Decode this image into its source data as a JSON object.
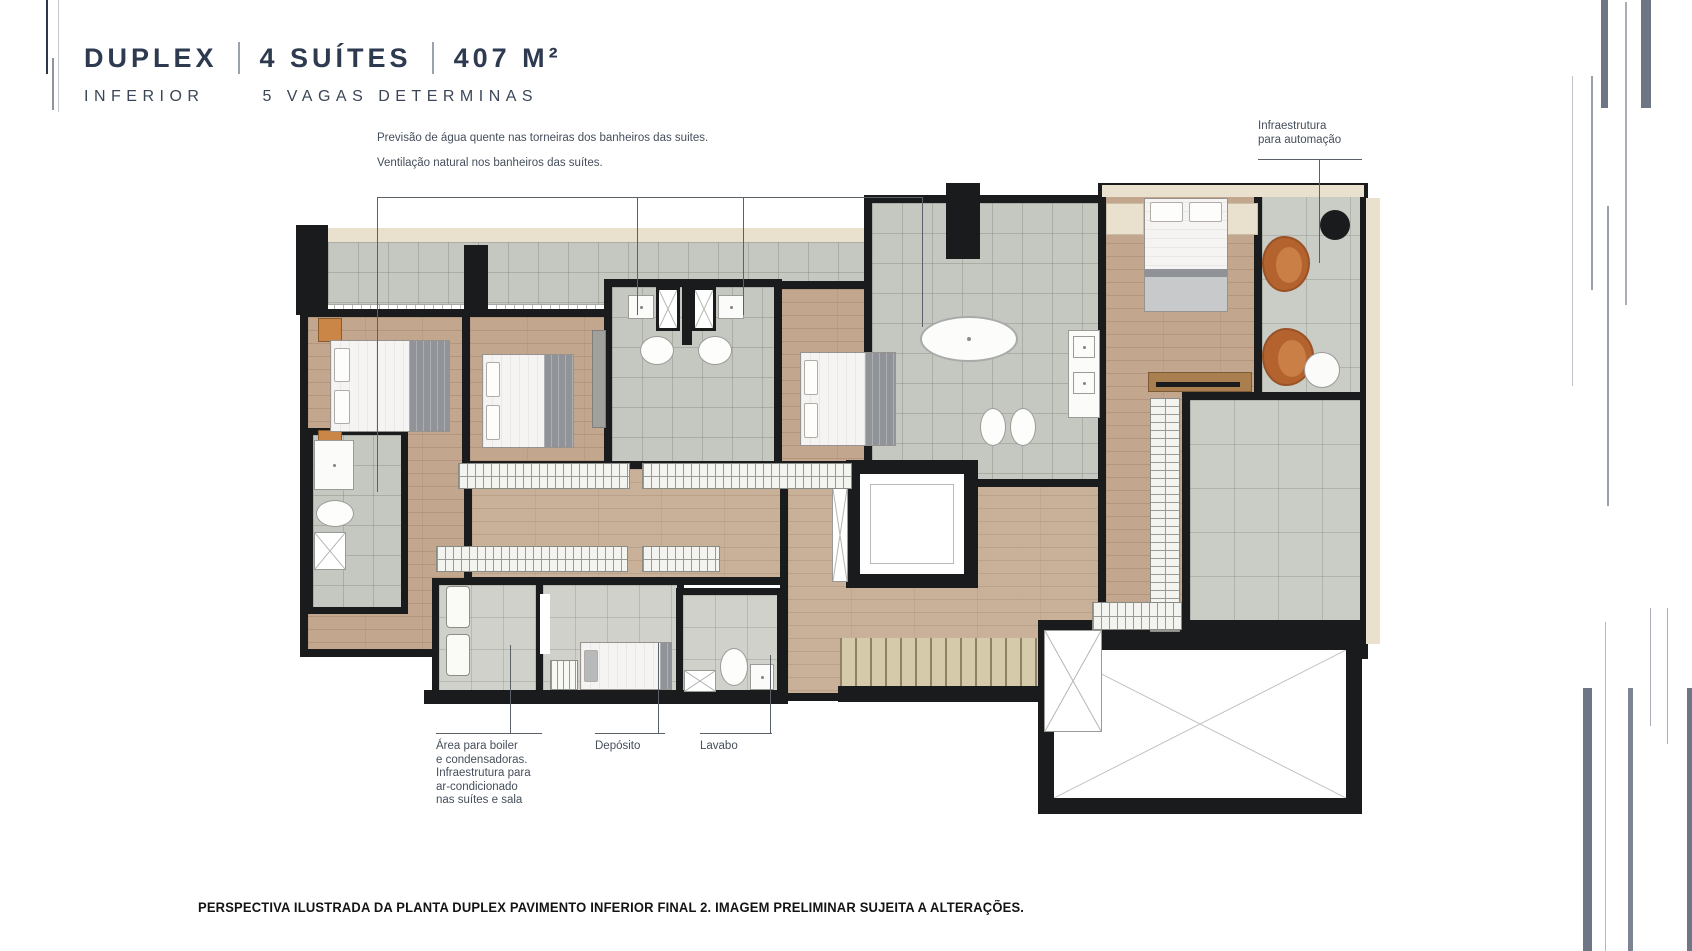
{
  "header": {
    "title_parts": [
      "DUPLEX",
      "4 SUÍTES",
      "407 M²"
    ],
    "subtitle_left": "INFERIOR",
    "subtitle_right": "5 VAGAS DETERMINAS"
  },
  "annotations": {
    "water": "Previsão de água quente nas torneiras dos banheiros das suites.",
    "ventilation": "Ventilação natural nos banheiros das suítes.",
    "automation": {
      "line1": "Infraestrutura",
      "line2": "para automação"
    },
    "boiler": {
      "lines": [
        "Área para boiler",
        "e condensadoras.",
        "Infraestrutura para",
        "ar-condicionado",
        "nas suítes e sala"
      ]
    },
    "deposito": "Depósito",
    "lavabo": "Lavabo"
  },
  "caption": "PERSPECTIVA ILUSTRADA DA PLANTA DUPLEX PAVIMENTO INFERIOR FINAL 2. IMAGEM PRELIMINAR SUJEITA A ALTERAÇÕES.",
  "palette": {
    "title": "#2d3a4f",
    "subtitle": "#3a4656",
    "annotation": "#454e5b",
    "caption": "#141414",
    "wall": "#1a1b1d",
    "wood": "#c3a68e",
    "wood_light": "#c9b098",
    "tile": "#c5c8c1",
    "tile_terrace": "#cacdc6",
    "tile_service": "#d0d1ca",
    "cream": "#e9e0cd",
    "leather": "#b4622e",
    "stairs": "#d5caa9",
    "accent_bar": "#6e7686"
  }
}
